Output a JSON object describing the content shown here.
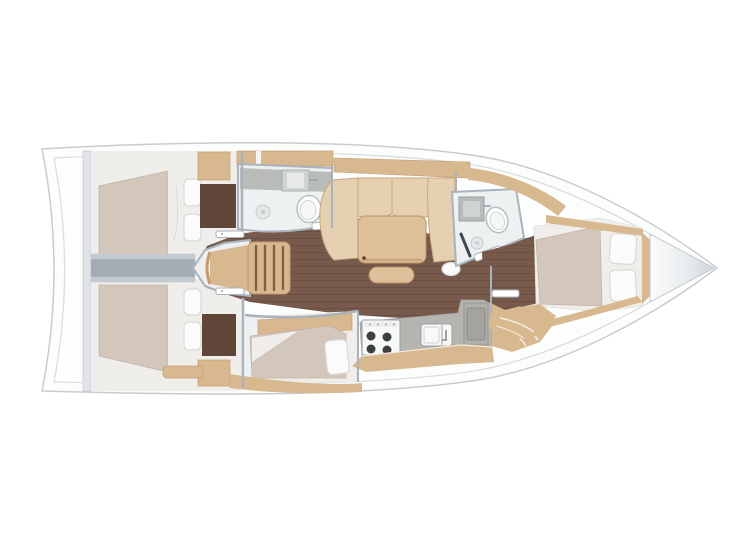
{
  "page": {
    "background": "#ffffff"
  },
  "diagram": {
    "type": "boat-floor-plan",
    "orientation": "bow-right",
    "rooms": [
      "aft-cabin-port",
      "aft-cabin-starboard",
      "aft-head",
      "companionway-stairs",
      "salon",
      "galley",
      "mid-cabin-berth",
      "forward-head",
      "forward-cabin",
      "anchor-locker"
    ],
    "fixtures": [
      "double-bed",
      "pillows",
      "wardrobe",
      "l-shaped-sofa",
      "salon-table",
      "stool",
      "stove-4-burner",
      "sink",
      "fridge",
      "toilet",
      "washbasin",
      "shower-drain",
      "island-bed",
      "pouf",
      "cabin-doors"
    ]
  },
  "palette": {
    "page-bg": "#ffffff",
    "hull-fill": "#fcfdfd",
    "hull-line": "#c8ccd2",
    "deck-line": "#dadde1",
    "bulkhead": "#e0e3e7",
    "wall": "#aab2bb",
    "beam-light": "#c5cad1",
    "beam-dark": "#a4acb6",
    "floor-wood": "#775a4c",
    "floor-wood-line": "#6a4e41",
    "floor-dark": "#5f4638",
    "wood-tan": "#d7b88f",
    "wood-tan-dark": "#c49a6c",
    "wood-step-gap": "#8a5c3c",
    "cushion": "#e6d0b2",
    "cushion-line": "#c7a77e",
    "table-wood": "#dec09a",
    "table-edge": "#bd9266",
    "mattress": "#d3c6ba",
    "linen": "#f0eeea",
    "pillow": "#fbfbfb",
    "pillow-line": "#d9d9d9",
    "wet-floor": "#eef1f2",
    "counter": "#b9bcb9",
    "counter-galley": "#b6b4b0",
    "white-goods": "#f7f8f8",
    "steel": "#9aa0a4",
    "appliance-dark": "#3d4043",
    "bow-shade": "#ced3d8"
  }
}
